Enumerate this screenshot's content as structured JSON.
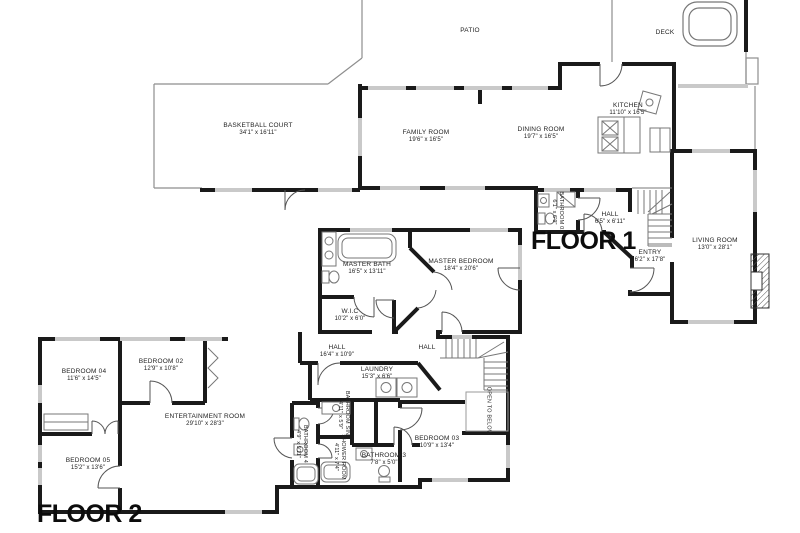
{
  "title": "Two-floor residential floor plan",
  "colors": {
    "wall": "#1a1a1a",
    "window": "#c9c9c9",
    "outline": "#8e8e8e",
    "text": "#222222",
    "background": "#ffffff"
  },
  "floor1": {
    "label": "FLOOR 1",
    "rooms": {
      "patio": {
        "name": "PATIO",
        "dims": ""
      },
      "deck": {
        "name": "DECK",
        "dims": ""
      },
      "basketball_court": {
        "name": "BASKETBALL COURT",
        "dims": "34'1\" x 16'11\""
      },
      "family_room": {
        "name": "FAMILY ROOM",
        "dims": "19'6\" x 16'5\""
      },
      "dining_room": {
        "name": "DINING ROOM",
        "dims": "19'7\" x 16'5\""
      },
      "kitchen": {
        "name": "KITCHEN",
        "dims": "11'10\" x 16'5\""
      },
      "hall": {
        "name": "HALL",
        "dims": "6'5\" x 6'11\""
      },
      "bathroom_01": {
        "name": "BATHROOM 01",
        "dims": "6'1\" x 6'9\""
      },
      "entry": {
        "name": "ENTRY",
        "dims": "6'2\" x 17'8\""
      },
      "living_room": {
        "name": "LIVING ROOM",
        "dims": "13'0\" x 28'1\""
      }
    }
  },
  "floor2": {
    "label": "FLOOR 2",
    "rooms": {
      "master_bath": {
        "name": "MASTER BATH",
        "dims": "16'5\" x 13'11\""
      },
      "master_bedroom": {
        "name": "MASTER BEDROOM",
        "dims": "18'4\" x 20'6\""
      },
      "wic": {
        "name": "W.I.C",
        "dims": "10'2\" x 6'0\""
      },
      "hall_west": {
        "name": "HALL",
        "dims": "16'4\" x 10'9\""
      },
      "hall_stairs": {
        "name": "HALL",
        "dims": ""
      },
      "laundry": {
        "name": "LAUNDRY",
        "dims": "15'3\" x 6'6\""
      },
      "bedroom_02": {
        "name": "BEDROOM 02",
        "dims": "12'9\" x 10'8\""
      },
      "bedroom_03": {
        "name": "BEDROOM 03",
        "dims": "10'9\" x 13'4\""
      },
      "bedroom_04": {
        "name": "BEDROOM 04",
        "dims": "11'6\" x 14'5\""
      },
      "bedroom_05": {
        "name": "BEDROOM 05",
        "dims": "15'2\" x 13'6\""
      },
      "entertainment_room": {
        "name": "ENTERTAINMENT ROOM",
        "dims": "29'10\" x 28'3\""
      },
      "bathroom_3": {
        "name": "BATHROOM 3",
        "dims": "7'8\" x 5'0\""
      },
      "bathroom_4": {
        "name": "BATHROOM 4",
        "dims": "4'9\" x 9'11\""
      },
      "bathroom_sink": {
        "name": "BATHROOM SINK",
        "dims": "4'11\" x 5'9\""
      },
      "shower_room": {
        "name": "SHOWER ROOM",
        "dims": "4'11\" x 7'4\""
      },
      "open_to_below": {
        "name": "OPEN TO BELOW",
        "dims": ""
      }
    }
  }
}
